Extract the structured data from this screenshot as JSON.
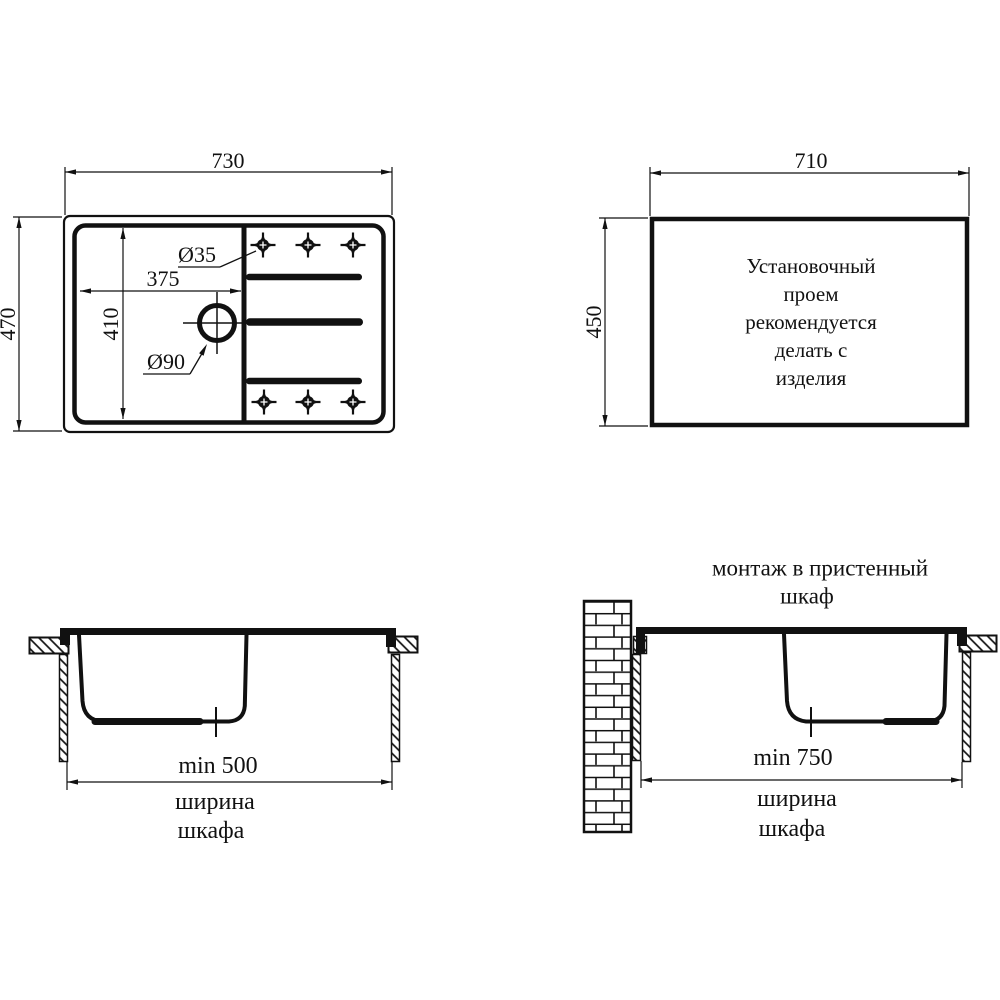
{
  "top_view": {
    "width_label": "730",
    "height_label": "470",
    "bowl_width_label": "375",
    "bowl_height_label": "410",
    "tap_hole_label": "Ø35",
    "drain_label": "Ø90"
  },
  "cutout_view": {
    "width_label": "710",
    "height_label": "450",
    "note_lines": [
      "Установочный",
      "проем",
      "рекомендуется",
      "делать с",
      "изделия"
    ]
  },
  "section_standard": {
    "min_width_label": "min 500",
    "caption_line1": "ширина",
    "caption_line2": "шкафа"
  },
  "section_wall": {
    "title_line1": "монтаж в пристенный",
    "title_line2": "шкаф",
    "min_width_label": "min 750",
    "caption_line1": "ширина",
    "caption_line2": "шкафа"
  },
  "colors": {
    "line": "#111111",
    "background": "#ffffff"
  }
}
